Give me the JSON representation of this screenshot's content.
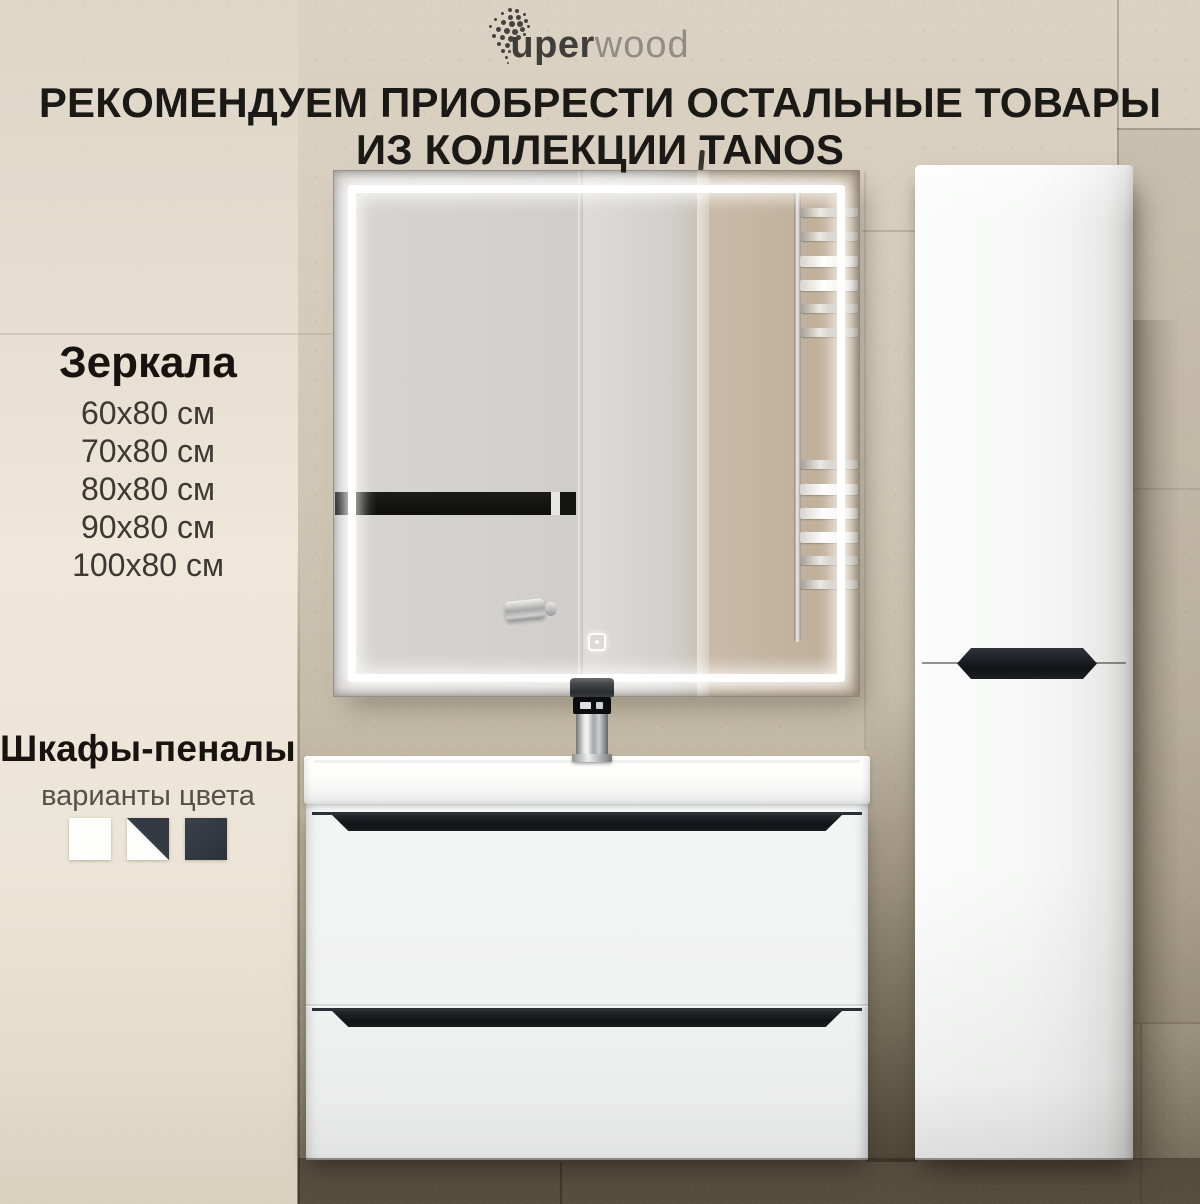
{
  "brand": {
    "name": "uperwood",
    "bold_part": "uper",
    "light_part": "wood"
  },
  "heading": {
    "line1": "РЕКОМЕНДУЕМ ПРИОБРЕСТИ ОСТАЛЬНЫЕ ТОВАРЫ",
    "line2": "ИЗ КОЛЛЕКЦИИ TANOS"
  },
  "mirrors": {
    "title": "Зеркала",
    "sizes": [
      "60х80 см",
      "70х80 см",
      "80х80 см",
      "90х80 см",
      "100х80 см"
    ]
  },
  "cabinets": {
    "title": "Шкафы-пеналы",
    "subtitle": "варианты цвета",
    "swatches": [
      {
        "name": "white",
        "hex": "#fdfdfc"
      },
      {
        "name": "white-and-graphite",
        "hex": "#fdfdfc / #333a43"
      },
      {
        "name": "graphite",
        "hex": "#333a43"
      }
    ]
  },
  "scene": {
    "collection": "TANOS",
    "objects": [
      "led-mirror",
      "towel-rail-reflection",
      "digital-faucet",
      "washbasin-vanity-two-drawers",
      "tall-pencil-cabinet"
    ],
    "colors": {
      "wall_beige": "#d5ccbc",
      "wall_dark_bottom": "#6b6251",
      "furniture_white": "#f3f4f4",
      "handle_black": "#15181b",
      "led_white": "#ffffff"
    }
  }
}
